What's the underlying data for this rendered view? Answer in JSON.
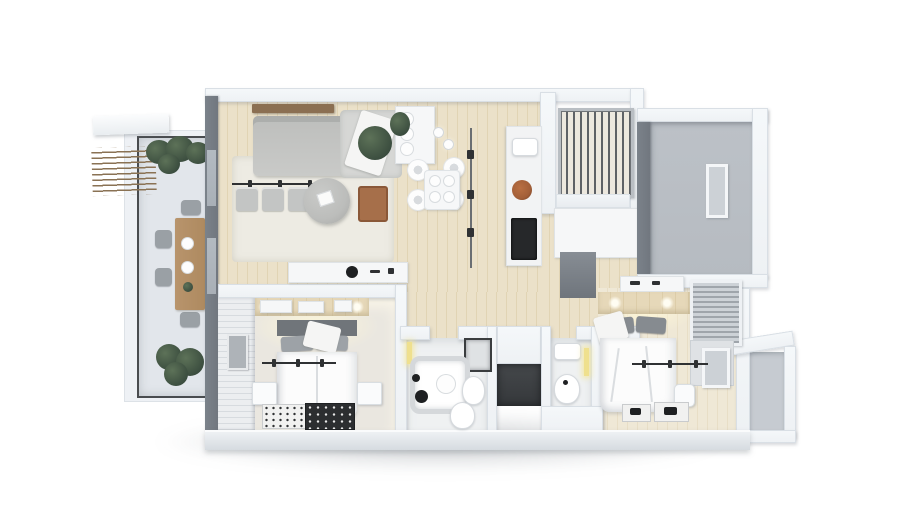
{
  "scene": {
    "type": "3d-floor-plan-render",
    "description": "Top-down 3D architectural render of a two-bedroom apartment with left-side balcony, open living/kitchen area, two bathrooms, storage closet, entry hall and a small side niche, on a white background with a soft drop shadow",
    "canvas": {
      "width": 900,
      "height": 523
    }
  },
  "palette": {
    "canvas": "#ffffff",
    "wall-white": "#eef1f4",
    "wall-edge": "#d9dfe5",
    "wall-dark": "#71777f",
    "window-glass": "#a9b0b7",
    "glass-band": "#eef1f5",
    "balcony-floor": "#e2e6eb",
    "rail-dark": "#494c4f",
    "pergola-wood": "#8a7254",
    "plant-dark": "#3a4c3e",
    "wood-table": "#ae8a60",
    "chair-gray": "#9aa0a5",
    "wood-floor": "#ebe1c9",
    "wood-stripe": "#e1d4b4",
    "rug-cream": "#edebe3",
    "sofa-gray": "#c9cac8",
    "sofa-light": "#d6d7d5",
    "shelf-wood": "#8b6f52",
    "pouf-gray": "#bcbdbb",
    "terracotta": "#a66f4a",
    "cabinet-white": "#f6f7f8",
    "appliance-dark": "#26282a",
    "copper": "#a35f38",
    "entry-floor": "#b6bbc1",
    "mirror-glass": "#ccd1d6",
    "radiator-slat": "#ece8de",
    "radiator-gap": "#5e6266",
    "panel-stripe-a": "#eceef0",
    "panel-stripe-b": "#d7dbdf",
    "wood-headboard": "#e6d8b9",
    "bed-white": "#fcfcfc",
    "headboard-dark": "#70757a",
    "pillow-gray": "#9da2a7",
    "rail-black": "#2f3133",
    "rug-black": "#2c2e30",
    "bath-floor": "#eff1f2",
    "tub-rim": "#d5d8db",
    "glow-yellow": "#efe08e",
    "closet-dark": "#35383b",
    "louver-a": "#cdd2d7",
    "louver-b": "#9fa5ab",
    "niche-floor": "#c6cbd1",
    "bottom-wall": "#d6dbe0",
    "floor-bedroom": "#eae7e0"
  },
  "rooms": [
    {
      "id": "balcony",
      "label": "balcony",
      "items": [
        "pergola-slats",
        "white-overhang-plank",
        "outdoor-dining-table",
        "outdoor-chairs",
        "potted-plants",
        "dark-framed-glass-railing"
      ]
    },
    {
      "id": "living-room",
      "label": "living-room",
      "items": [
        "corner-sofa",
        "white-throw-blanket",
        "wood-wall-shelf",
        "cream-area-rug",
        "round-pouf-table",
        "terracotta-chair",
        "wall-rail-with-cushions",
        "media-sideboard",
        "hanging-plant"
      ]
    },
    {
      "id": "kitchen-dining",
      "label": "kitchen-dining",
      "items": [
        "white-dining-table",
        "four-round-chairs",
        "pendant-lights",
        "tall-white-cabinet",
        "kitchen-counter",
        "dark-cooktop",
        "copper-pan",
        "track-light"
      ]
    },
    {
      "id": "utility-niche",
      "label": "utility-niche",
      "items": [
        "slatted-radiator",
        "white-shelf"
      ]
    },
    {
      "id": "entry-hall",
      "label": "entry-hall",
      "items": [
        "gray-floor",
        "leaning-mirror"
      ]
    },
    {
      "id": "bedroom-1",
      "label": "bedroom-1",
      "items": [
        "double-bed",
        "gray-pillows",
        "two-nightstands",
        "clothes-rail",
        "light-patterned-rug",
        "dark-patterned-rug",
        "slatted-wall-panel",
        "wall-art-frame",
        "wood-headboard-wall"
      ]
    },
    {
      "id": "bathroom-1",
      "label": "bathroom-1",
      "items": [
        "bathtub",
        "glass-shower",
        "toilet",
        "bidet",
        "round-sink",
        "yellow-wall-light",
        "black-stool"
      ]
    },
    {
      "id": "storage-closet",
      "label": "storage-closet",
      "items": [
        "dark-opening"
      ]
    },
    {
      "id": "bathroom-2",
      "label": "bathroom-2",
      "items": [
        "sink",
        "toilet",
        "yellow-wall-light"
      ]
    },
    {
      "id": "bedroom-2",
      "label": "bedroom-2",
      "items": [
        "double-bed",
        "louvered-wardrobe",
        "wood-accent-wall",
        "clothes-rail",
        "white-pouf",
        "two-bedside-rugs",
        "wall-frame",
        "entry-cabinet"
      ]
    },
    {
      "id": "side-niche",
      "label": "side-niche",
      "items": [
        "gray-floor"
      ]
    }
  ]
}
